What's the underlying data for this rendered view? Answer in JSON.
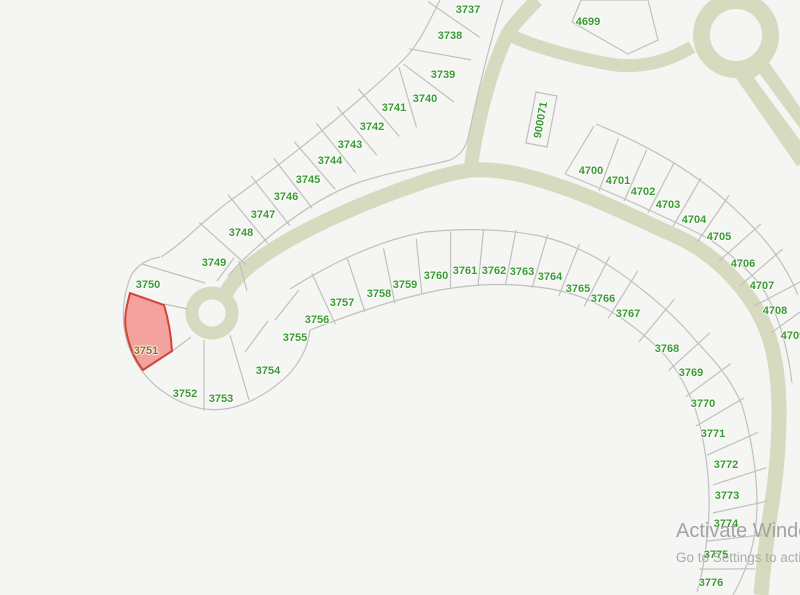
{
  "map": {
    "background": "#f5f5f3",
    "road_color": "#d7dabf",
    "lot_line_color": "#c0c0be",
    "label_color": "#3a9a33",
    "highlight": {
      "lot": "3751",
      "fill": "#f3a29d",
      "stroke": "#d0453a",
      "label_color": "#8a6d1e"
    }
  },
  "lots": [
    {
      "id": "3737",
      "x": 468,
      "y": 10,
      "group": "diagonal"
    },
    {
      "id": "3738",
      "x": 450,
      "y": 36,
      "group": "diagonal"
    },
    {
      "id": "3739",
      "x": 443,
      "y": 75,
      "group": "diagonal"
    },
    {
      "id": "3740",
      "x": 425,
      "y": 99,
      "group": "diagonal"
    },
    {
      "id": "3741",
      "x": 394,
      "y": 108,
      "group": "diagonal"
    },
    {
      "id": "3742",
      "x": 372,
      "y": 127,
      "group": "diagonal"
    },
    {
      "id": "3743",
      "x": 350,
      "y": 145,
      "group": "diagonal"
    },
    {
      "id": "3744",
      "x": 330,
      "y": 161,
      "group": "diagonal"
    },
    {
      "id": "3745",
      "x": 308,
      "y": 180,
      "group": "diagonal"
    },
    {
      "id": "3746",
      "x": 286,
      "y": 197,
      "group": "diagonal"
    },
    {
      "id": "3747",
      "x": 263,
      "y": 215,
      "group": "diagonal"
    },
    {
      "id": "3748",
      "x": 241,
      "y": 233,
      "group": "diagonal"
    },
    {
      "id": "3749",
      "x": 214,
      "y": 263,
      "group": "diagonal"
    },
    {
      "id": "3750",
      "x": 148,
      "y": 285,
      "group": "cluster"
    },
    {
      "id": "3751",
      "x": 146,
      "y": 351,
      "group": "cluster",
      "highlighted": true
    },
    {
      "id": "3752",
      "x": 185,
      "y": 394,
      "group": "cluster"
    },
    {
      "id": "3753",
      "x": 221,
      "y": 399,
      "group": "cluster"
    },
    {
      "id": "3754",
      "x": 268,
      "y": 371,
      "group": "cluster"
    },
    {
      "id": "3755",
      "x": 295,
      "y": 338,
      "group": "cluster"
    },
    {
      "id": "3756",
      "x": 317,
      "y": 320,
      "group": "crescent"
    },
    {
      "id": "3757",
      "x": 342,
      "y": 303,
      "group": "crescent"
    },
    {
      "id": "3758",
      "x": 379,
      "y": 294,
      "group": "crescent"
    },
    {
      "id": "3759",
      "x": 405,
      "y": 285,
      "group": "crescent"
    },
    {
      "id": "3760",
      "x": 436,
      "y": 276,
      "group": "crescent"
    },
    {
      "id": "3761",
      "x": 465,
      "y": 271,
      "group": "crescent"
    },
    {
      "id": "3762",
      "x": 494,
      "y": 271,
      "group": "crescent"
    },
    {
      "id": "3763",
      "x": 522,
      "y": 272,
      "group": "crescent"
    },
    {
      "id": "3764",
      "x": 550,
      "y": 277,
      "group": "crescent"
    },
    {
      "id": "3765",
      "x": 578,
      "y": 289,
      "group": "crescent"
    },
    {
      "id": "3766",
      "x": 603,
      "y": 299,
      "group": "crescent"
    },
    {
      "id": "3767",
      "x": 628,
      "y": 314,
      "group": "crescent"
    },
    {
      "id": "3768",
      "x": 667,
      "y": 349,
      "group": "crescent"
    },
    {
      "id": "3769",
      "x": 691,
      "y": 373,
      "group": "crescent"
    },
    {
      "id": "3770",
      "x": 703,
      "y": 404,
      "group": "crescent"
    },
    {
      "id": "3771",
      "x": 713,
      "y": 434,
      "group": "crescent"
    },
    {
      "id": "3772",
      "x": 726,
      "y": 465,
      "group": "crescent"
    },
    {
      "id": "3773",
      "x": 727,
      "y": 496,
      "group": "crescent"
    },
    {
      "id": "3774",
      "x": 726,
      "y": 524,
      "group": "crescent"
    },
    {
      "id": "3775",
      "x": 716,
      "y": 555,
      "group": "crescent"
    },
    {
      "id": "3776",
      "x": 711,
      "y": 583,
      "group": "crescent"
    },
    {
      "id": "4700",
      "x": 591,
      "y": 171,
      "group": "east"
    },
    {
      "id": "4701",
      "x": 618,
      "y": 181,
      "group": "east"
    },
    {
      "id": "4702",
      "x": 643,
      "y": 192,
      "group": "east"
    },
    {
      "id": "4703",
      "x": 668,
      "y": 205,
      "group": "east"
    },
    {
      "id": "4704",
      "x": 694,
      "y": 220,
      "group": "east"
    },
    {
      "id": "4705",
      "x": 719,
      "y": 237,
      "group": "east"
    },
    {
      "id": "4706",
      "x": 743,
      "y": 264,
      "group": "east"
    },
    {
      "id": "4707",
      "x": 762,
      "y": 286,
      "group": "east"
    },
    {
      "id": "4708",
      "x": 775,
      "y": 311,
      "group": "east"
    },
    {
      "id": "4709",
      "x": 793,
      "y": 336,
      "group": "east"
    },
    {
      "id": "4699",
      "x": 588,
      "y": 22,
      "group": "other"
    },
    {
      "id": "900071",
      "x": 541,
      "y": 120,
      "group": "other",
      "rotate": -80
    }
  ],
  "division_config": [
    {
      "group": "diagonal",
      "mode": "local",
      "sign": 1,
      "inOff": 25,
      "outOff": 38
    },
    {
      "group": "crescent",
      "mode": "radial",
      "cx": 450,
      "cy": 570,
      "inOff": 14,
      "outOff": 42
    },
    {
      "group": "east",
      "mode": "local",
      "sign": -1,
      "inOff": 16,
      "outOff": 40
    }
  ],
  "watermark": {
    "line1": "Activate Windows",
    "line2": "Go to Settings to activate Windows."
  }
}
